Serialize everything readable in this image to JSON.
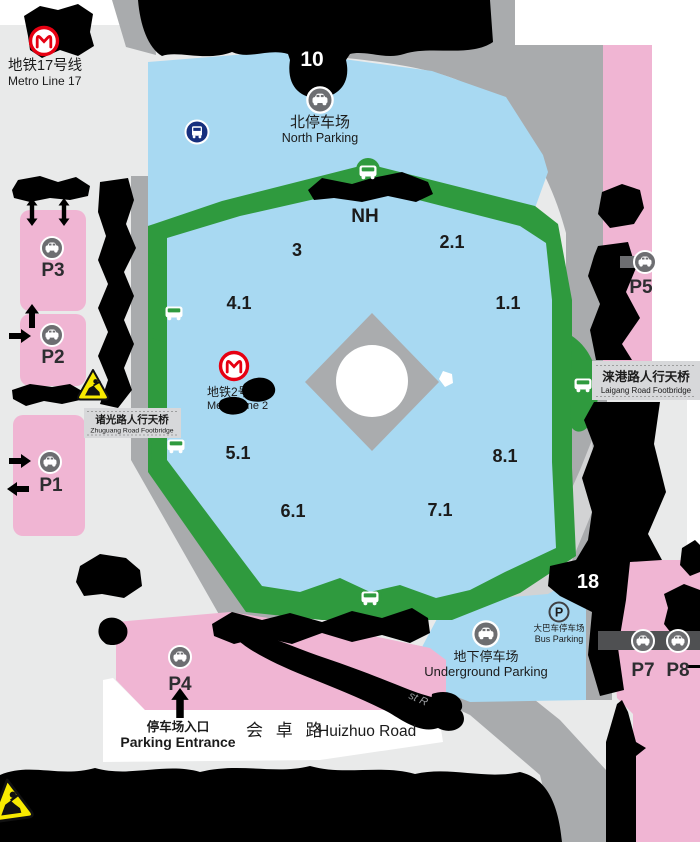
{
  "colors": {
    "ground_gray": "#e9eaea",
    "road_gray": "#a9abad",
    "road_light": "#d2d3d4",
    "hall_blue": "#a8d9f2",
    "ring_green": "#2f9a3e",
    "parking_pink": "#f0b5d3",
    "metro_red": "#e60012",
    "bus_navy": "#17307e",
    "warning_yellow": "#f8ea00",
    "icon_gray": "#6d6e71",
    "bar_dark": "#4f5052",
    "box_gray": "#d7d8da"
  },
  "metro": {
    "line17": {
      "zh": "地铁17号线",
      "en": "Metro Line 17"
    },
    "line2": {
      "zh": "地铁2号线",
      "en": "Metro Line 2"
    }
  },
  "gates": {
    "north": "10",
    "south": "18"
  },
  "halls": {
    "nh": "NH",
    "h3": "3",
    "h21": "2.1",
    "h41": "4.1",
    "h11": "1.1",
    "h51": "5.1",
    "h61": "6.1",
    "h71": "7.1",
    "h81": "8.1"
  },
  "parking": {
    "north": {
      "zh": "北停车场",
      "en": "North Parking"
    },
    "underground": {
      "zh": "地下停车场",
      "en": "Underground Parking"
    },
    "bus": {
      "zh": "大巴车停车场",
      "en": "Bus Parking",
      "symbol": "P"
    },
    "lots": {
      "p1": "P1",
      "p2": "P2",
      "p3": "P3",
      "p4": "P4",
      "p5": "P5",
      "p7": "P7",
      "p8": "P8"
    },
    "entrance": {
      "zh": "停车场入口",
      "en": "Parking Entrance"
    }
  },
  "footbridges": {
    "zhuguang": {
      "zh": "诸光路人行天桥",
      "en": "Zhuguang Road Footbridge"
    },
    "laigang": {
      "zh": "涞港路人行天桥",
      "en": "Laigang Road Footbridge"
    }
  },
  "roads": {
    "huizhuo_zh": "会 卓 路",
    "huizhuo_en": "Huizhuo Road",
    "fragment": "st R"
  }
}
